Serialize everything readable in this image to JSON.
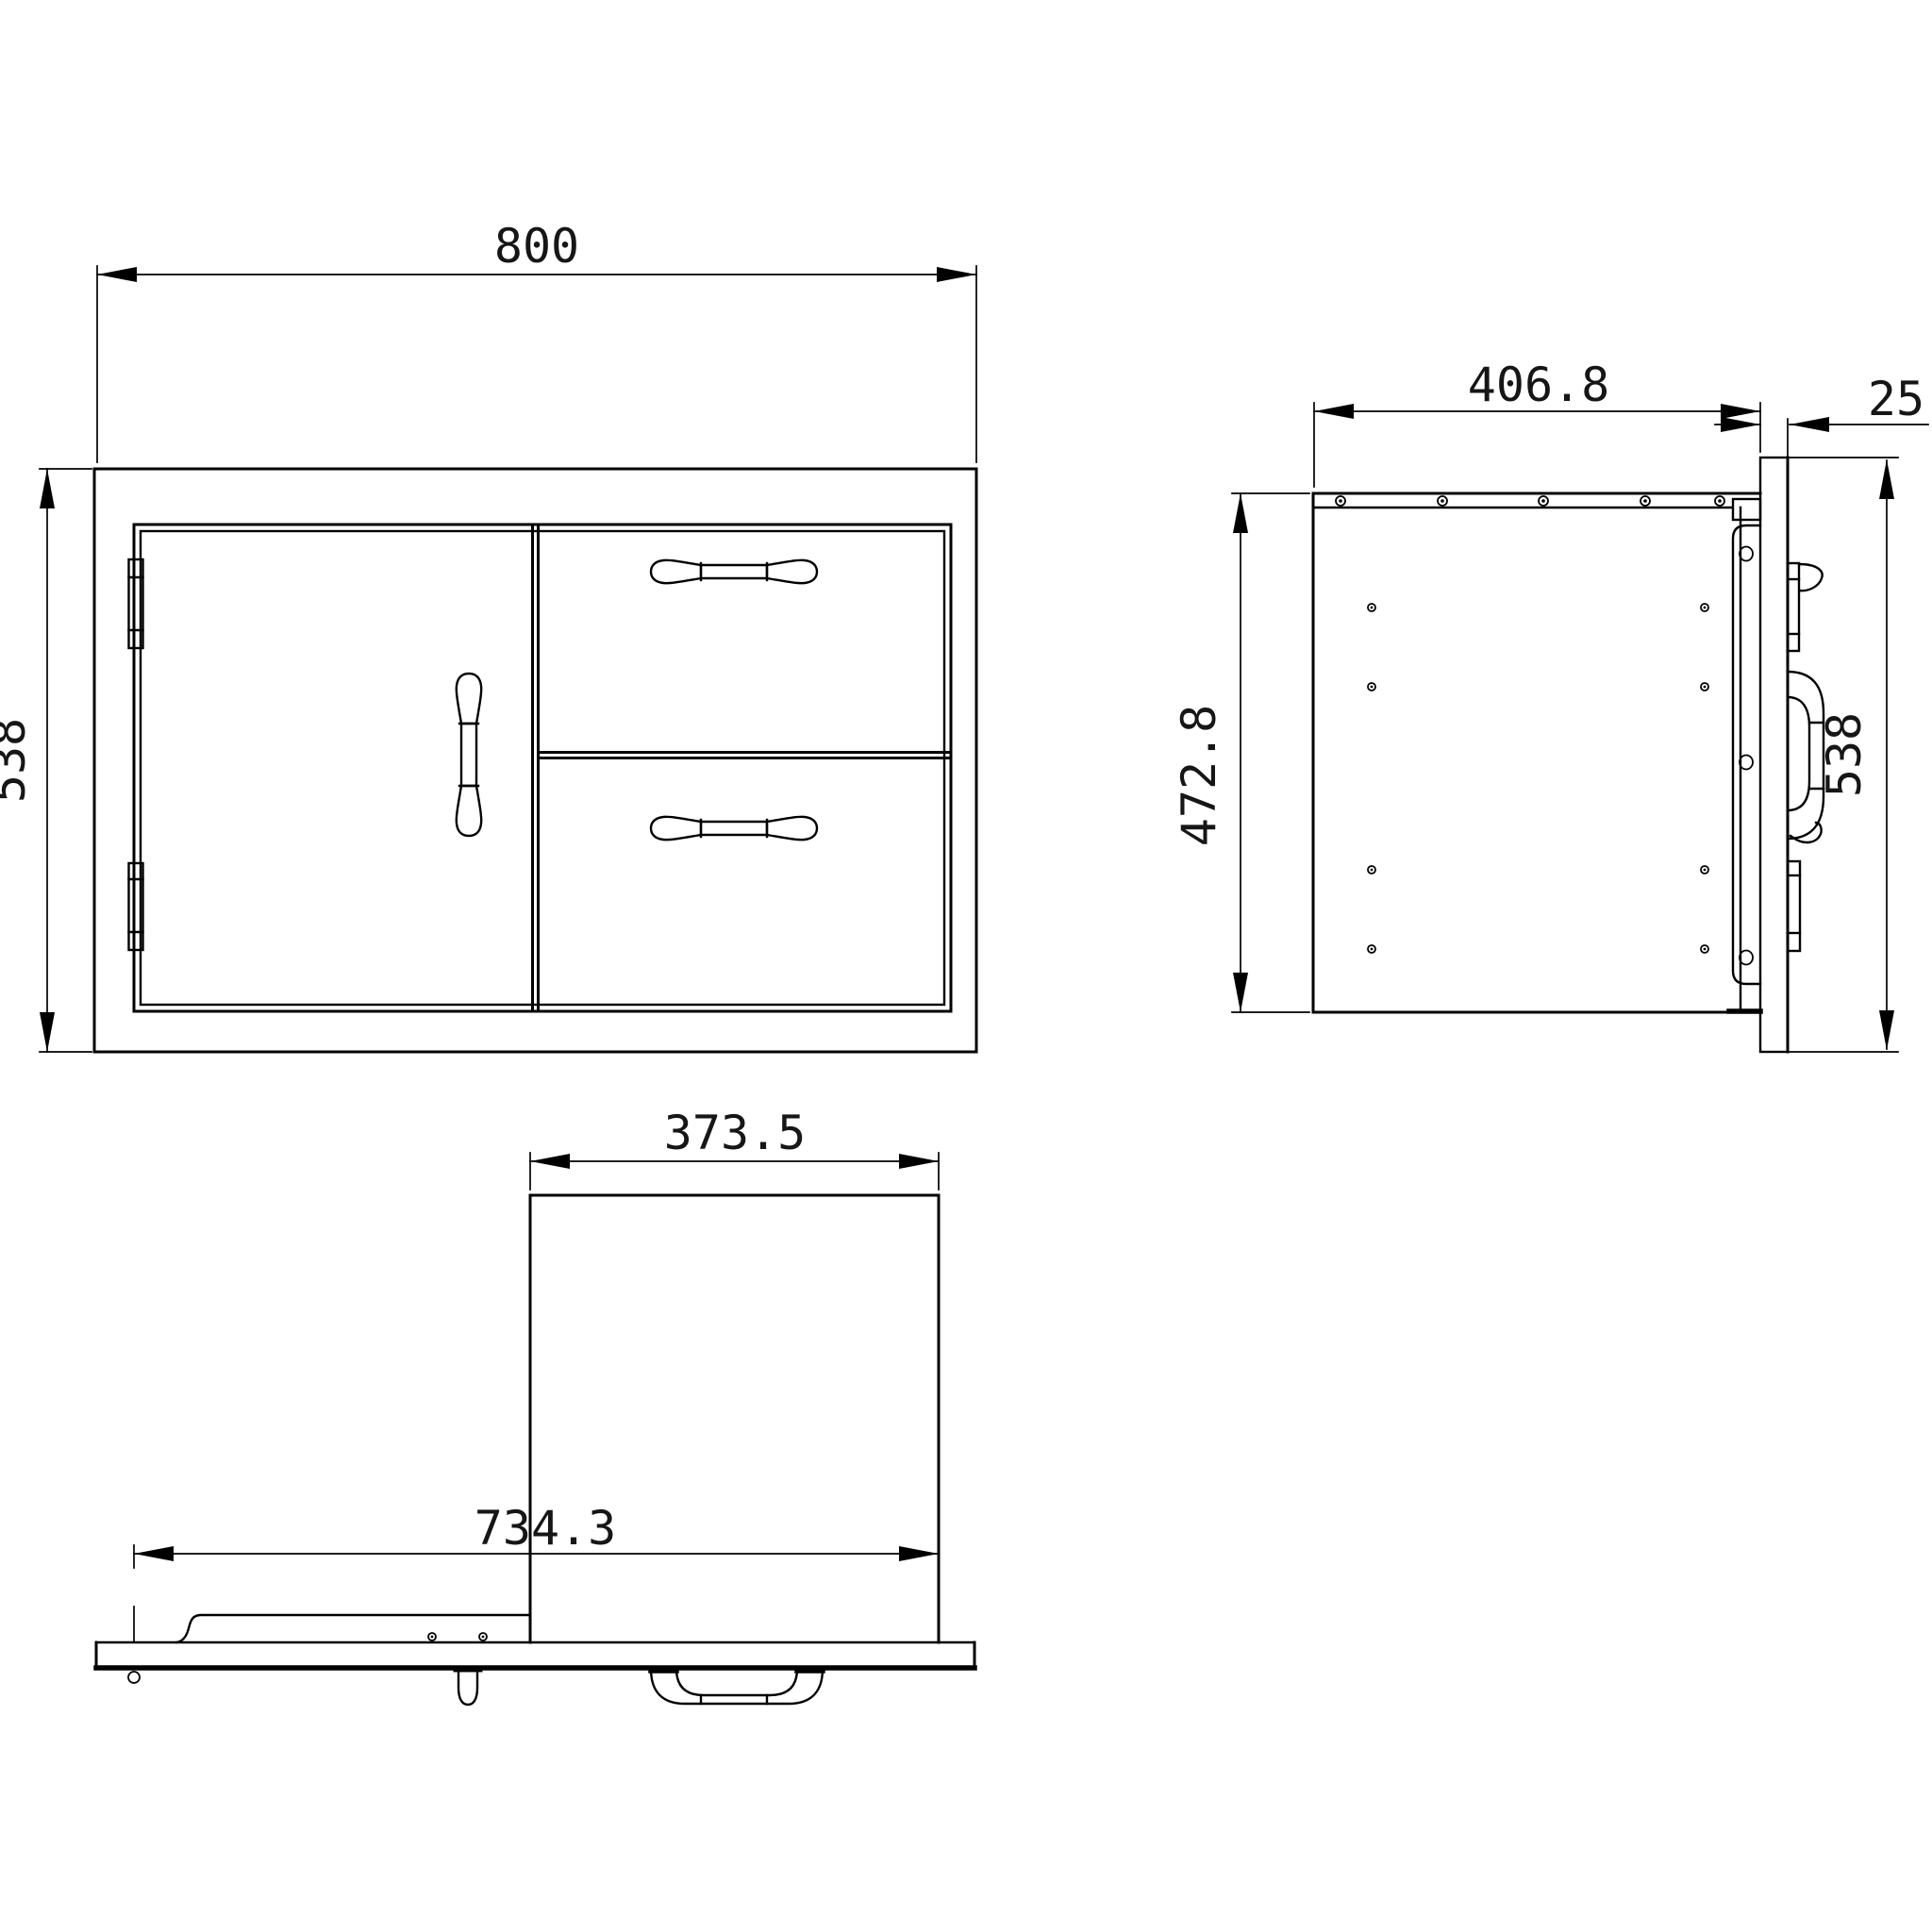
{
  "colors": {
    "background": "#ffffff",
    "line": "#000000",
    "text": "#161616"
  },
  "dims": {
    "front_width": "800",
    "front_height": "538",
    "side_depth": "406.8",
    "side_panel_thickness": "25",
    "side_body_height": "472.8",
    "side_panel_height": "538",
    "bottom_drawer_depth": "373.5",
    "bottom_slide_extension": "734.3"
  }
}
